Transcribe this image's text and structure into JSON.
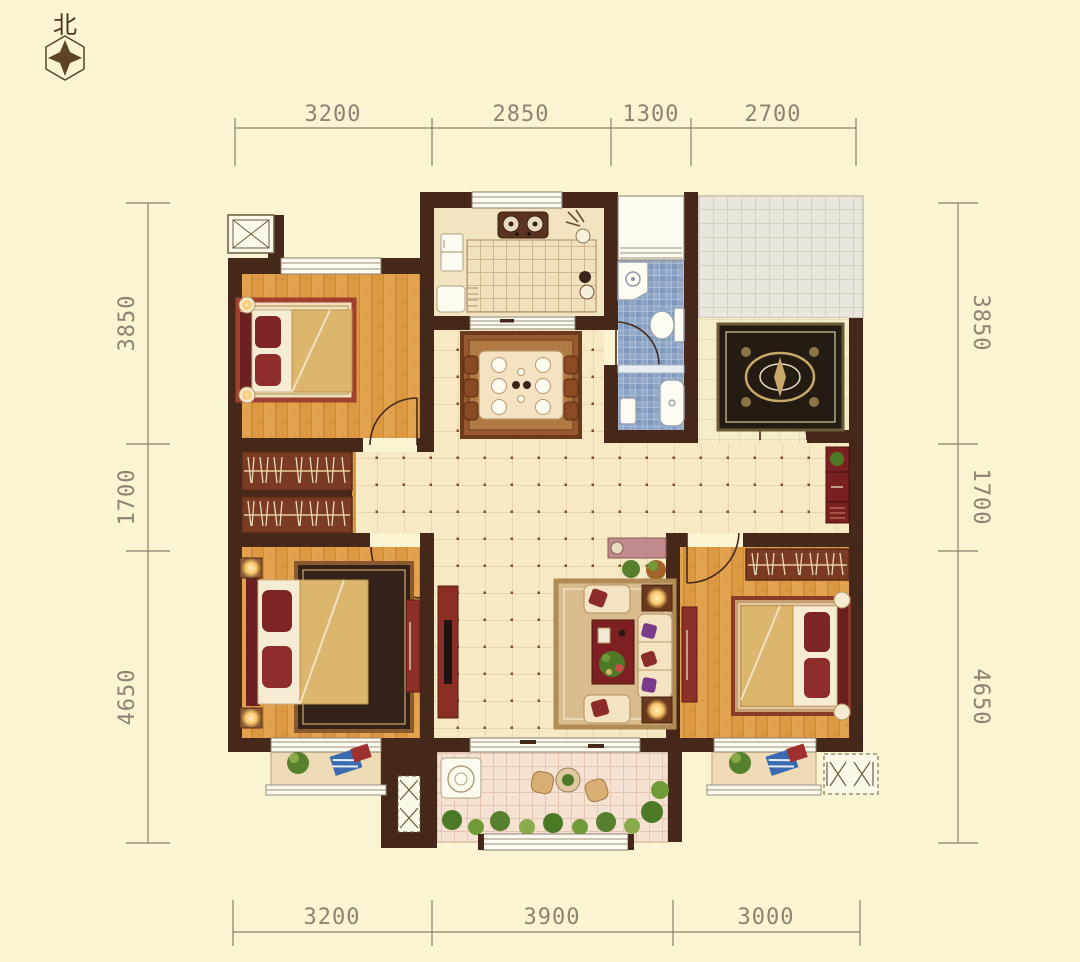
{
  "north_indicator": {
    "label": "北"
  },
  "dimensions": {
    "top": {
      "values": [
        "3200",
        "2850",
        "1300",
        "2700"
      ]
    },
    "bottom": {
      "values": [
        "3200",
        "3900",
        "3000"
      ]
    },
    "left": {
      "values": [
        "3850",
        "1700",
        "4650"
      ]
    },
    "right": {
      "values": [
        "3850",
        "1700",
        "4650"
      ]
    }
  },
  "colors": {
    "background": "#fbf4d3",
    "wall": "#45281a",
    "wood_floor": "#e3a24e",
    "hall_tile": "#f6e9c4",
    "hall_dot": "#7d4e28",
    "bathroom_tile": "#8aa3c4",
    "public_corridor_tile": "#eae6dd",
    "balcony_tile": "#f6e2d2",
    "furniture_red": "#8c2f26",
    "rug_dark": "#241c12",
    "rug_gold": "#c9a96a",
    "dimension_text": "#8e8272",
    "lamp_glow": "#f8c76a"
  },
  "rooms": [
    {
      "id": "bedroom-top-left"
    },
    {
      "id": "bedroom-bottom-left"
    },
    {
      "id": "bedroom-bottom-right"
    },
    {
      "id": "kitchen"
    },
    {
      "id": "bathroom"
    },
    {
      "id": "dining-area"
    },
    {
      "id": "living-room"
    },
    {
      "id": "entry-foyer"
    },
    {
      "id": "public-corridor"
    },
    {
      "id": "main-balcony"
    },
    {
      "id": "left-balcony"
    },
    {
      "id": "right-balcony"
    },
    {
      "id": "elevator"
    },
    {
      "id": "ac-platform-left"
    },
    {
      "id": "ac-platform-right"
    }
  ]
}
